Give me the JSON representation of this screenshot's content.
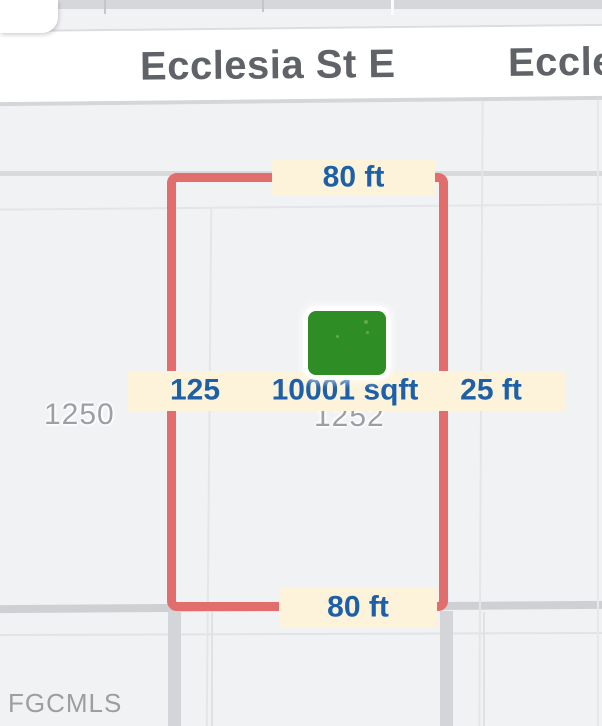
{
  "streets": {
    "primary": "Ecclesia St E",
    "secondary_partial": "Eccle"
  },
  "parcels": {
    "left_label": "1250",
    "center_label": "1252"
  },
  "measurements": {
    "top_width": "80 ft",
    "bottom_width": "80 ft",
    "left_value": "125",
    "area": "10001 sqft",
    "right_depth": "25 ft"
  },
  "watermark": "FGCMLS",
  "colors": {
    "boundary_red": "#e16d6d",
    "label_cream": "#fcf3da",
    "measure_blue": "#1d5fa8",
    "building_green": "#2f8d26",
    "street_text_gray": "#5f6368",
    "parcel_text_gray": "#9ba0a6",
    "map_background": "#f1f2f4"
  }
}
